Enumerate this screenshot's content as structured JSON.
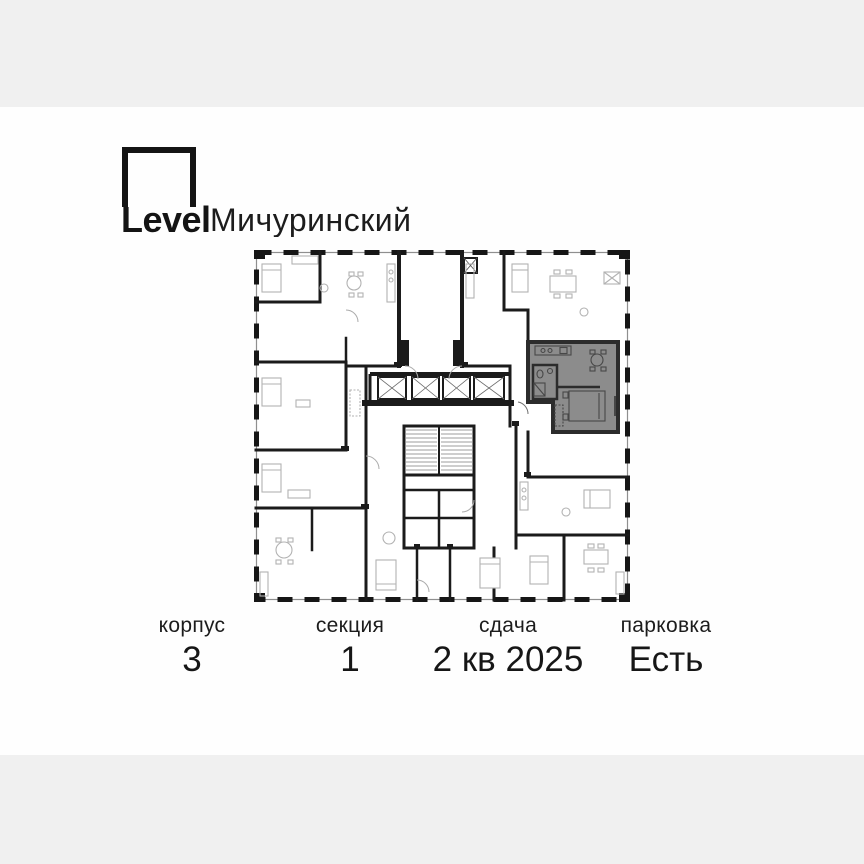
{
  "page": {
    "background_color": "#f0f0f0",
    "card_background_color": "#fefefe"
  },
  "logo": {
    "brand": "Level",
    "project": "Мичуринский"
  },
  "floor_plan": {
    "kind": "building-floor-plan",
    "highlight_color": "#8c8c8c",
    "wall_color": "#1b1b1b",
    "selected_apartment": "gray-highlighted-unit-right-side",
    "elevators_count": 4
  },
  "footer": {
    "items": [
      {
        "label": "корпус",
        "value": "3"
      },
      {
        "label": "секция",
        "value": "1"
      },
      {
        "label": "сдача",
        "value": "2 кв 2025"
      },
      {
        "label": "парковка",
        "value": "Есть"
      }
    ]
  }
}
